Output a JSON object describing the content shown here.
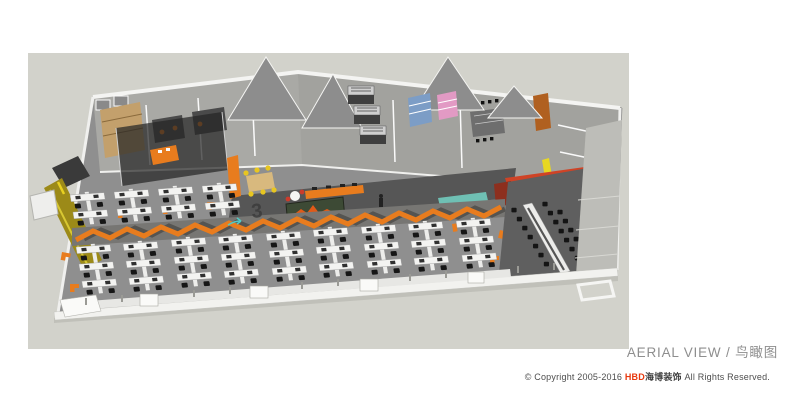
{
  "caption": {
    "title_en": "AERIAL VIEW",
    "separator": " / ",
    "title_cn": "鸟瞰图",
    "color": "#8e8e8e"
  },
  "footer": {
    "prefix": "© Copyright 2005-2016 ",
    "brand_en": "HBD",
    "brand_cn": "海博装饰",
    "suffix": " All Rights Reserved.",
    "brand_color": "#e8380d",
    "text_color": "#4d4d4d"
  },
  "scene": {
    "description": "3D aerial rendering of an open-plan office floor with workstation pods, meeting rooms, reception logo wall and training area",
    "floor_numeral": "3",
    "colors": {
      "backdrop_gray": "#d2d2cb",
      "carpet_gray": "#858585",
      "dark_floor": "#585858",
      "accent_orange": "#e87c1e",
      "brand_red": "#cf4326",
      "teal_counter": "#6fc0b4",
      "yellow_wall": "#9c8a18",
      "yellow_strip": "#e8d822",
      "logo_wall_green": "#3d4a35",
      "blue_shelf": "#7c9dc6",
      "pink_shelf": "#e29ac4",
      "wood_tan": "#c3a06c",
      "desk_white": "#f3f3f1",
      "chair_black": "#161616",
      "facade_white": "#f2f2ef"
    }
  }
}
